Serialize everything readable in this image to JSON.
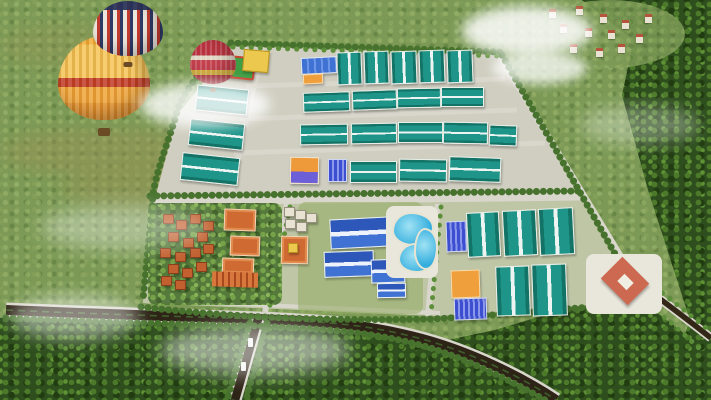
{
  "scene": {
    "kind": "aerial-3d-render",
    "subject": "industrial-park-master-plan",
    "setting": "green-countryside-with-forest-village-and-hot-air-balloons"
  },
  "colors": {
    "grass": "#7c9a56",
    "forest": "#2e4e1e",
    "teal": "#1f958a",
    "tealD": "#127366",
    "orange": "#efa03c",
    "roof": "#c2602f",
    "pool": "#35aede",
    "diamond": "#cd6950",
    "road_dark": "#2d2316",
    "road_light": "#d9d6cc",
    "pavement": "#cfcec0",
    "south_lawn": "#bfc6a6",
    "tree_row": "#47722d"
  },
  "legend": {
    "wh": "warehouse-landscape",
    "wv": "warehouse-portrait",
    "blue": "blue-factory",
    "solar": "solar-roof-building",
    "orange": "orange-factory",
    "op": "orange-purple-factory",
    "villa": "villa",
    "obig": "courtyard-building",
    "row": "row-houses",
    "whitev": "small-villa",
    "broof": "blue-roof-building",
    "pool": "swimming-pool",
    "sport": "sports-field",
    "yellow": "yellow-building",
    "plaza": "plaza",
    "diamond": "diamond-ring-building",
    "diamondin": "diamond-courtyard",
    "house": "village-house",
    "car": "vehicle"
  },
  "balloons": [
    {
      "style": "yellow",
      "x": 58,
      "y": 36,
      "w": 92,
      "h": 100
    },
    {
      "style": "striped",
      "x": 93,
      "y": 1,
      "w": 70,
      "h": 66
    },
    {
      "style": "red",
      "x": 190,
      "y": 40,
      "w": 46,
      "h": 52
    }
  ],
  "clouds": [
    {
      "x": 140,
      "y": 82,
      "w": 130,
      "h": 45,
      "o": 0.8,
      "bl": 6
    },
    {
      "x": 462,
      "y": 6,
      "w": 130,
      "h": 50,
      "o": 0.85,
      "bl": 6
    },
    {
      "x": 492,
      "y": 52,
      "w": 95,
      "h": 32,
      "o": 0.75,
      "bl": 5
    },
    {
      "x": 160,
      "y": 325,
      "w": 190,
      "h": 50,
      "o": 0.5,
      "bl": 9
    },
    {
      "x": 40,
      "y": 205,
      "w": 170,
      "h": 45,
      "o": 0.35,
      "bl": 9
    },
    {
      "x": 580,
      "y": 105,
      "w": 120,
      "h": 40,
      "o": 0.3,
      "bl": 8
    },
    {
      "x": 10,
      "y": 295,
      "w": 130,
      "h": 45,
      "o": 0.45,
      "bl": 8
    }
  ],
  "village_houses": [
    [
      549,
      9
    ],
    [
      576,
      6
    ],
    [
      600,
      14
    ],
    [
      560,
      24
    ],
    [
      585,
      28
    ],
    [
      608,
      30
    ],
    [
      622,
      20
    ],
    [
      570,
      44
    ],
    [
      596,
      48
    ],
    [
      618,
      44
    ],
    [
      636,
      34
    ],
    [
      645,
      14
    ]
  ],
  "park": {
    "buildings": [
      {
        "t": "wv",
        "x": 337,
        "y": 52,
        "w": 23,
        "h": 31,
        "r": -2
      },
      {
        "t": "wv",
        "x": 364,
        "y": 51,
        "w": 23,
        "h": 31,
        "r": -2
      },
      {
        "t": "wv",
        "x": 391,
        "y": 51,
        "w": 24,
        "h": 31,
        "r": -2
      },
      {
        "t": "wv",
        "x": 419,
        "y": 50,
        "w": 24,
        "h": 31,
        "r": -2
      },
      {
        "t": "wv",
        "x": 447,
        "y": 50,
        "w": 24,
        "h": 31,
        "r": -2
      },
      {
        "t": "blue",
        "x": 301,
        "y": 57,
        "w": 34,
        "h": 15,
        "r": -3
      },
      {
        "t": "orange",
        "x": 303,
        "y": 74,
        "w": 18,
        "h": 8,
        "r": -3
      },
      {
        "t": "sport",
        "x": 221,
        "y": 56,
        "w": 30,
        "h": 19,
        "r": 6
      },
      {
        "t": "yellow",
        "x": 243,
        "y": 50,
        "w": 24,
        "h": 20,
        "r": 5
      },
      {
        "t": "wh",
        "x": 196,
        "y": 87,
        "w": 50,
        "h": 24,
        "r": 6
      },
      {
        "t": "wh",
        "x": 189,
        "y": 121,
        "w": 53,
        "h": 25,
        "r": 6
      },
      {
        "t": "wh",
        "x": 181,
        "y": 155,
        "w": 56,
        "h": 26,
        "r": 6
      },
      {
        "t": "wh",
        "x": 303,
        "y": 92,
        "w": 45,
        "h": 18,
        "r": -2
      },
      {
        "t": "wh",
        "x": 352,
        "y": 90,
        "w": 43,
        "h": 18,
        "r": -2
      },
      {
        "t": "wh",
        "x": 397,
        "y": 88,
        "w": 42,
        "h": 18,
        "r": -1
      },
      {
        "t": "wh",
        "x": 441,
        "y": 87,
        "w": 41,
        "h": 18,
        "r": 0
      },
      {
        "t": "wh",
        "x": 300,
        "y": 124,
        "w": 46,
        "h": 19,
        "r": -1
      },
      {
        "t": "wh",
        "x": 351,
        "y": 123,
        "w": 44,
        "h": 19,
        "r": -1
      },
      {
        "t": "wh",
        "x": 398,
        "y": 122,
        "w": 43,
        "h": 19,
        "r": 0
      },
      {
        "t": "wh",
        "x": 443,
        "y": 122,
        "w": 43,
        "h": 20,
        "r": 1
      },
      {
        "t": "wh",
        "x": 489,
        "y": 125,
        "w": 26,
        "h": 19,
        "r": 2
      },
      {
        "t": "op",
        "x": 290,
        "y": 157,
        "w": 27,
        "h": 25,
        "r": 1
      },
      {
        "t": "solar",
        "x": 328,
        "y": 159,
        "w": 17,
        "h": 21,
        "r": 0
      },
      {
        "t": "wh",
        "x": 350,
        "y": 161,
        "w": 45,
        "h": 20,
        "r": 0
      },
      {
        "t": "wh",
        "x": 399,
        "y": 159,
        "w": 46,
        "h": 21,
        "r": 1
      },
      {
        "t": "wh",
        "x": 449,
        "y": 157,
        "w": 50,
        "h": 23,
        "r": 2
      },
      {
        "t": "villa",
        "x": 163,
        "y": 214,
        "w": 9,
        "h": 8
      },
      {
        "t": "villa",
        "x": 176,
        "y": 220,
        "w": 9,
        "h": 8
      },
      {
        "t": "villa",
        "x": 190,
        "y": 214,
        "w": 9,
        "h": 8
      },
      {
        "t": "villa",
        "x": 203,
        "y": 221,
        "w": 9,
        "h": 8
      },
      {
        "t": "villa",
        "x": 168,
        "y": 232,
        "w": 9,
        "h": 8
      },
      {
        "t": "villa",
        "x": 183,
        "y": 238,
        "w": 9,
        "h": 8
      },
      {
        "t": "villa",
        "x": 197,
        "y": 232,
        "w": 9,
        "h": 8
      },
      {
        "t": "villa",
        "x": 160,
        "y": 248,
        "w": 9,
        "h": 8
      },
      {
        "t": "villa",
        "x": 175,
        "y": 252,
        "w": 9,
        "h": 8
      },
      {
        "t": "villa",
        "x": 190,
        "y": 248,
        "w": 9,
        "h": 8
      },
      {
        "t": "villa",
        "x": 203,
        "y": 244,
        "w": 9,
        "h": 8
      },
      {
        "t": "villa",
        "x": 168,
        "y": 264,
        "w": 9,
        "h": 8
      },
      {
        "t": "villa",
        "x": 182,
        "y": 268,
        "w": 9,
        "h": 8
      },
      {
        "t": "villa",
        "x": 196,
        "y": 262,
        "w": 9,
        "h": 8
      },
      {
        "t": "villa",
        "x": 161,
        "y": 276,
        "w": 9,
        "h": 8
      },
      {
        "t": "villa",
        "x": 175,
        "y": 280,
        "w": 9,
        "h": 8
      },
      {
        "t": "obig",
        "x": 224,
        "y": 209,
        "w": 30,
        "h": 20,
        "r": 2
      },
      {
        "t": "obig",
        "x": 230,
        "y": 236,
        "w": 28,
        "h": 18,
        "r": 2
      },
      {
        "t": "obig",
        "x": 222,
        "y": 258,
        "w": 30,
        "h": 14,
        "r": 2
      },
      {
        "t": "row",
        "x": 212,
        "y": 272,
        "w": 46,
        "h": 15,
        "r": 2
      },
      {
        "t": "whitev",
        "x": 284,
        "y": 207,
        "w": 9,
        "h": 8
      },
      {
        "t": "whitev",
        "x": 295,
        "y": 210,
        "w": 9,
        "h": 8
      },
      {
        "t": "whitev",
        "x": 306,
        "y": 213,
        "w": 9,
        "h": 8
      },
      {
        "t": "whitev",
        "x": 285,
        "y": 219,
        "w": 9,
        "h": 8
      },
      {
        "t": "whitev",
        "x": 296,
        "y": 222,
        "w": 9,
        "h": 8
      },
      {
        "t": "obig",
        "x": 281,
        "y": 236,
        "w": 25,
        "h": 26,
        "r": 1
      },
      {
        "t": "yellow",
        "x": 288,
        "y": 243,
        "w": 8,
        "h": 8
      },
      {
        "t": "broof",
        "x": 330,
        "y": 218,
        "w": 56,
        "h": 28,
        "r": -3
      },
      {
        "t": "broof",
        "x": 324,
        "y": 251,
        "w": 48,
        "h": 24,
        "r": -2
      },
      {
        "t": "broof",
        "x": 371,
        "y": 259,
        "w": 32,
        "h": 22,
        "r": -2
      },
      {
        "t": "broof",
        "x": 377,
        "y": 283,
        "w": 27,
        "h": 13,
        "r": -1
      },
      {
        "t": "plaza",
        "x": 386,
        "y": 206,
        "w": 52,
        "h": 72
      },
      {
        "t": "pool",
        "x": 392,
        "y": 212,
        "w": 38,
        "h": 30
      },
      {
        "t": "pool",
        "x": 398,
        "y": 243,
        "w": 34,
        "h": 26
      },
      {
        "t": "pool",
        "x": 414,
        "y": 228,
        "w": 20,
        "h": 38
      },
      {
        "t": "solar",
        "x": 446,
        "y": 221,
        "w": 19,
        "h": 29,
        "r": -2
      },
      {
        "t": "wv",
        "x": 467,
        "y": 212,
        "w": 31,
        "h": 43,
        "r": -3
      },
      {
        "t": "wv",
        "x": 503,
        "y": 210,
        "w": 32,
        "h": 44,
        "r": -3
      },
      {
        "t": "wv",
        "x": 539,
        "y": 208,
        "w": 33,
        "h": 45,
        "r": -3
      },
      {
        "t": "orange",
        "x": 451,
        "y": 270,
        "w": 27,
        "h": 26,
        "r": -2
      },
      {
        "t": "solar",
        "x": 454,
        "y": 298,
        "w": 31,
        "h": 20,
        "r": -2
      },
      {
        "t": "wv",
        "x": 496,
        "y": 266,
        "w": 32,
        "h": 48,
        "r": -2
      },
      {
        "t": "wv",
        "x": 532,
        "y": 264,
        "w": 33,
        "h": 50,
        "r": -2
      },
      {
        "t": "plaza",
        "x": 586,
        "y": 254,
        "w": 76,
        "h": 60
      },
      {
        "t": "diamond",
        "x": 606,
        "y": 263,
        "w": 38,
        "h": 36
      },
      {
        "t": "diamondin",
        "x": 619,
        "y": 276,
        "w": 13,
        "h": 12
      },
      {
        "t": "car",
        "x": 248,
        "y": 338,
        "w": 5,
        "h": 9
      },
      {
        "t": "car",
        "x": 241,
        "y": 362,
        "w": 5,
        "h": 9
      }
    ]
  }
}
